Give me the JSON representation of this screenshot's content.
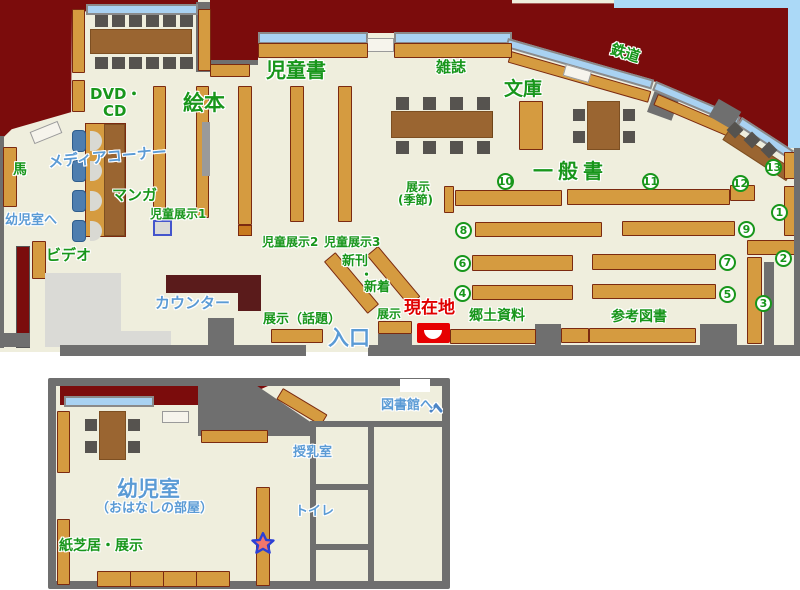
{
  "palette": {
    "exterior_red": "#7B0C0C",
    "floor_cream": "#EFEEDD",
    "wall_gray": "#6F6F6F",
    "shelf_tan": "#D59B40",
    "shelf_border": "#7B2A10",
    "table_brown": "#9A6531",
    "chair_dark": "#56534F",
    "chair_blue": "#4E7EAF",
    "window_blue": "#A9D2F2",
    "outside_blue": "#ABD9F7",
    "counter_maroon": "#5A1B1B",
    "light_gray": "#DADAD6",
    "label_green": "#18961B",
    "label_blue": "#5B9BD5",
    "label_red": "#E00000",
    "marker_red": "#E60000",
    "star_fill": "#F2766B",
    "star_stroke": "#2B3FD6"
  },
  "upper": {
    "labels": {
      "jidosho": "児童書",
      "ehon": "絵本",
      "dvd": "DVD・",
      "cd": "CD",
      "media_corner": "メディアコーナー",
      "manga": "マンガ",
      "uma": "馬",
      "yojishitsu_e": "幼児室へ",
      "video": "ビデオ",
      "counter": "カウンター",
      "jido_tenji1": "児童展示1",
      "jido_tenji2": "児童展示2",
      "jido_tenji3": "児童展示3",
      "zasshi": "雑誌",
      "bunko": "文庫",
      "tetsudo": "鉄道",
      "ippansho": "一般書",
      "tenji_kisetsu1": "展示",
      "tenji_kisetsu2": "(季節)",
      "shinkan": "新刊",
      "nakaguro": "・",
      "shinchaku": "新着",
      "tenji_wadai": "展示（話題）",
      "tenji": "展示",
      "genzaichi": "現在地",
      "iriguchi": "入口",
      "kyodo_shiryo": "郷土資料",
      "sanko_tosho": "参考図書"
    },
    "numbers": [
      "1",
      "2",
      "3",
      "4",
      "5",
      "6",
      "7",
      "8",
      "9",
      "10",
      "11",
      "12",
      "13"
    ]
  },
  "lower": {
    "labels": {
      "toshokan_e": "図書館へ",
      "junyushitsu": "授乳室",
      "toire": "トイレ",
      "yojishitsu": "幼児室",
      "ohanashi": "（おはなしの部屋）",
      "kamishibai": "紙芝居・展示"
    }
  }
}
